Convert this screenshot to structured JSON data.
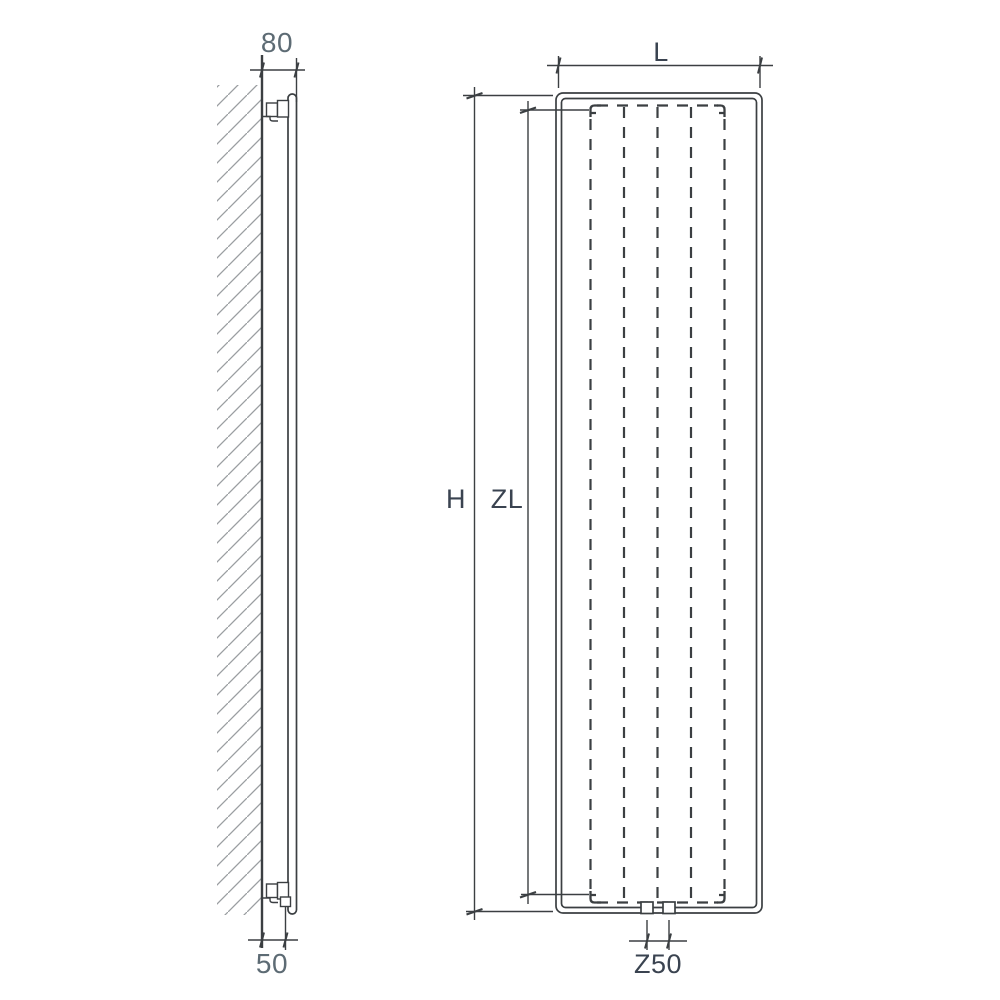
{
  "colors": {
    "background": "#ffffff",
    "line": "#3b3f42",
    "hatch": "#9a9ea1",
    "numeric_text": "#5d6b74",
    "letter_text": "#3a4350"
  },
  "side_view": {
    "depth_label": "80",
    "pipe_offset_label": "50"
  },
  "front_view": {
    "width_label": "L",
    "height_label": "H",
    "inner_height_label": "ZL",
    "connection_label": "Z50"
  }
}
